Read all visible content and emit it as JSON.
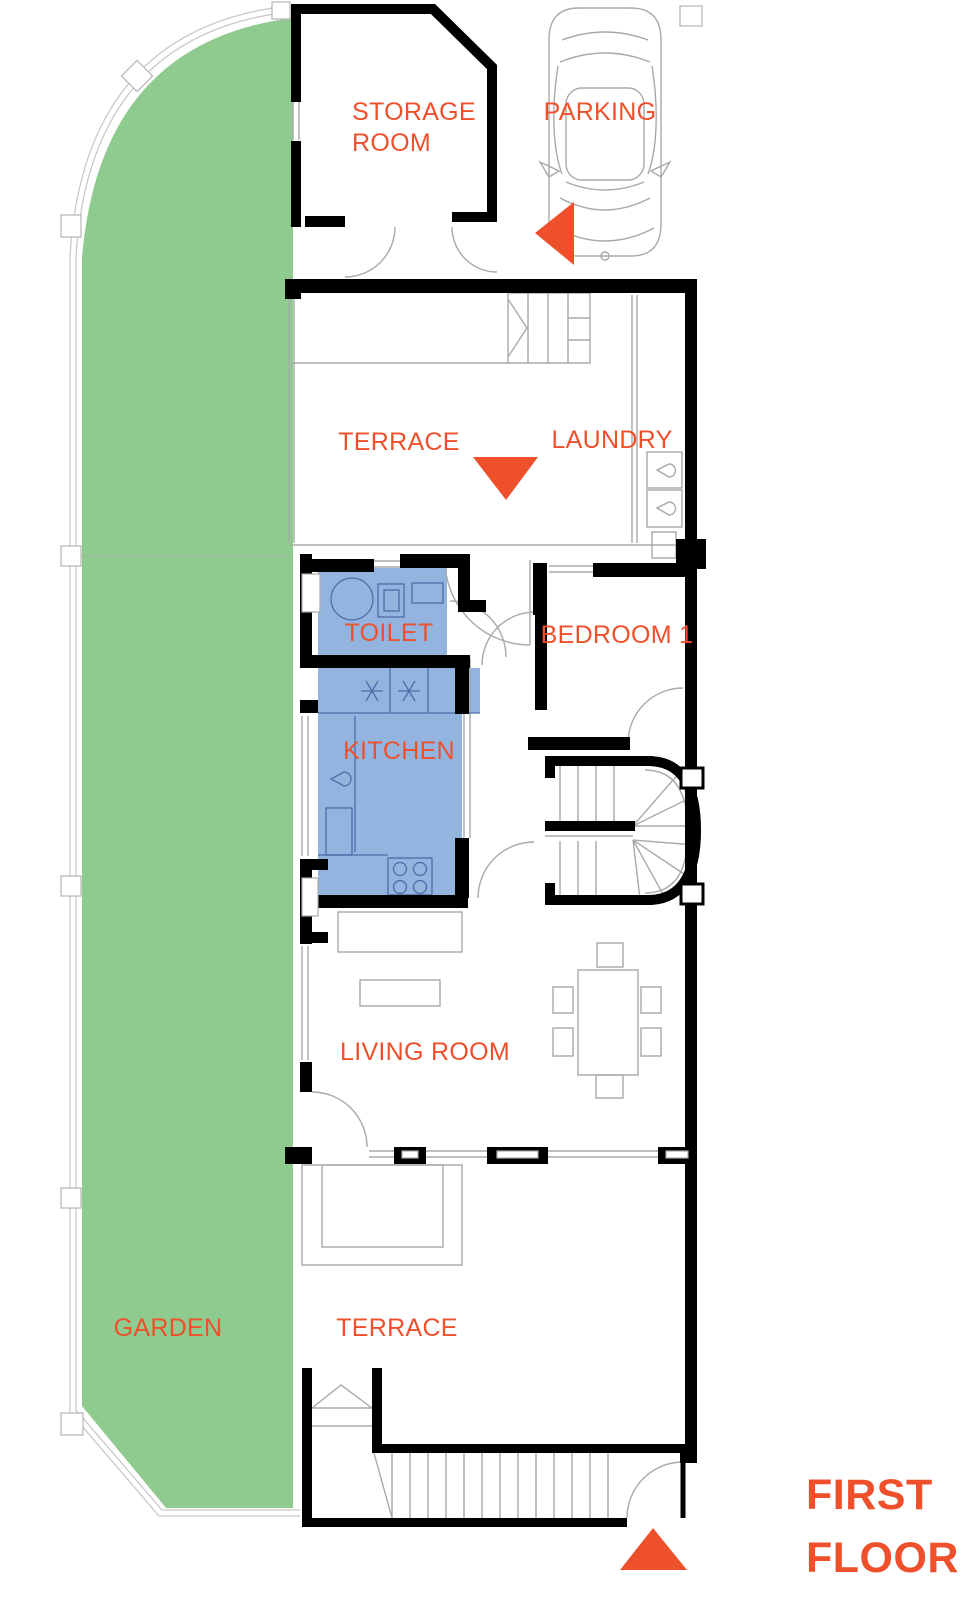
{
  "title": {
    "line1": "FIRST",
    "line2": "FLOOR"
  },
  "rooms": {
    "storage_room": {
      "line1": "STORAGE",
      "line2": "ROOM"
    },
    "parking": "PARKING",
    "terrace_upper": "TERRACE",
    "laundry": "LAUNDRY",
    "toilet": "TOILET",
    "bedroom_1": "BEDROOM 1",
    "kitchen": "KITCHEN",
    "living_room": "LIVING ROOM",
    "garden": "GARDEN",
    "terrace_lower": "TERRACE"
  },
  "colors": {
    "accent": "#ef502c",
    "garden_fill": "#8fcb8f",
    "wet_room_fill": "#93b4df",
    "wall": "#000000",
    "fixture_line": "#a9a9a9",
    "wet_fixture_line": "#4a6da7"
  },
  "icons": {
    "car": "car-top-view-icon",
    "parking_arrow": "arrow-left-icon",
    "terrace_arrow": "arrow-down-icon",
    "entrance_arrow": "arrow-up-icon"
  }
}
